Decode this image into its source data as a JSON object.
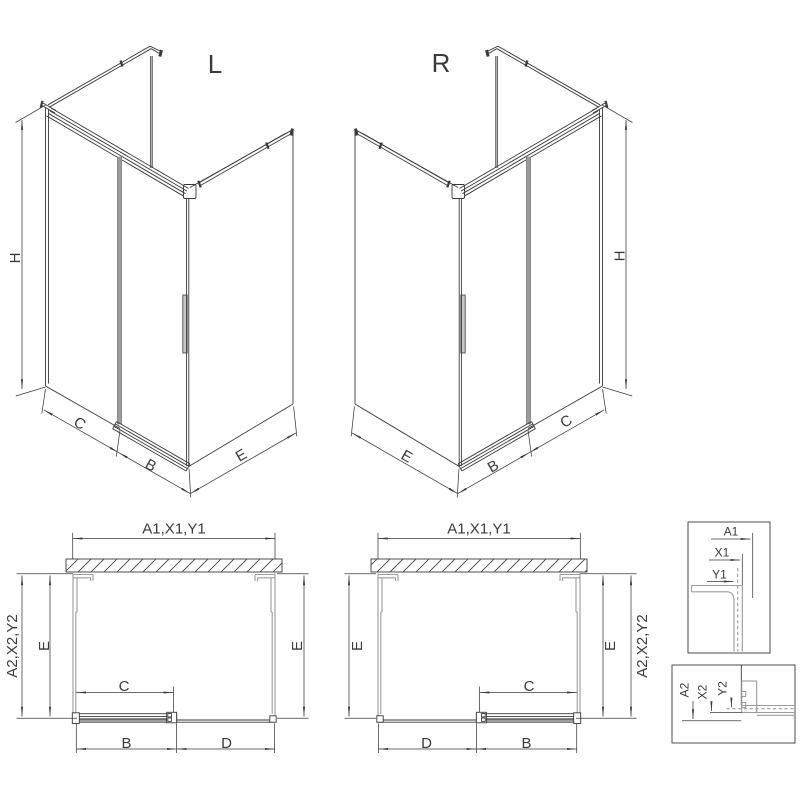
{
  "colors": {
    "line": "#3a3a3a",
    "profile": "#9b9b9b",
    "door_accent": "#9b9b9b",
    "background": "#ffffff"
  },
  "iso_views": {
    "left": {
      "title": "L",
      "dims": {
        "height": "H",
        "fixed_side": "C",
        "door": "B",
        "return_panel": "E"
      }
    },
    "right": {
      "title": "R",
      "dims": {
        "height": "H",
        "fixed_side": "C",
        "door": "B",
        "return_panel": "E"
      }
    }
  },
  "plan_views": {
    "left": {
      "dims": {
        "width": "A1,X1,Y1",
        "depth": "A2,X2,Y2",
        "side_left": "E",
        "side_right": "E",
        "opening": "C",
        "door": "B",
        "fixed": "D"
      }
    },
    "right": {
      "dims": {
        "width": "A1,X1,Y1",
        "depth": "A2,X2,Y2",
        "side_left": "E",
        "side_right": "E",
        "opening": "C",
        "door": "B",
        "fixed": "D"
      }
    }
  },
  "details": {
    "wall_profile": {
      "dims": [
        "A1",
        "X1",
        "Y1"
      ]
    },
    "rail_profile": {
      "dims": [
        "A2",
        "X2",
        "Y2"
      ]
    }
  }
}
